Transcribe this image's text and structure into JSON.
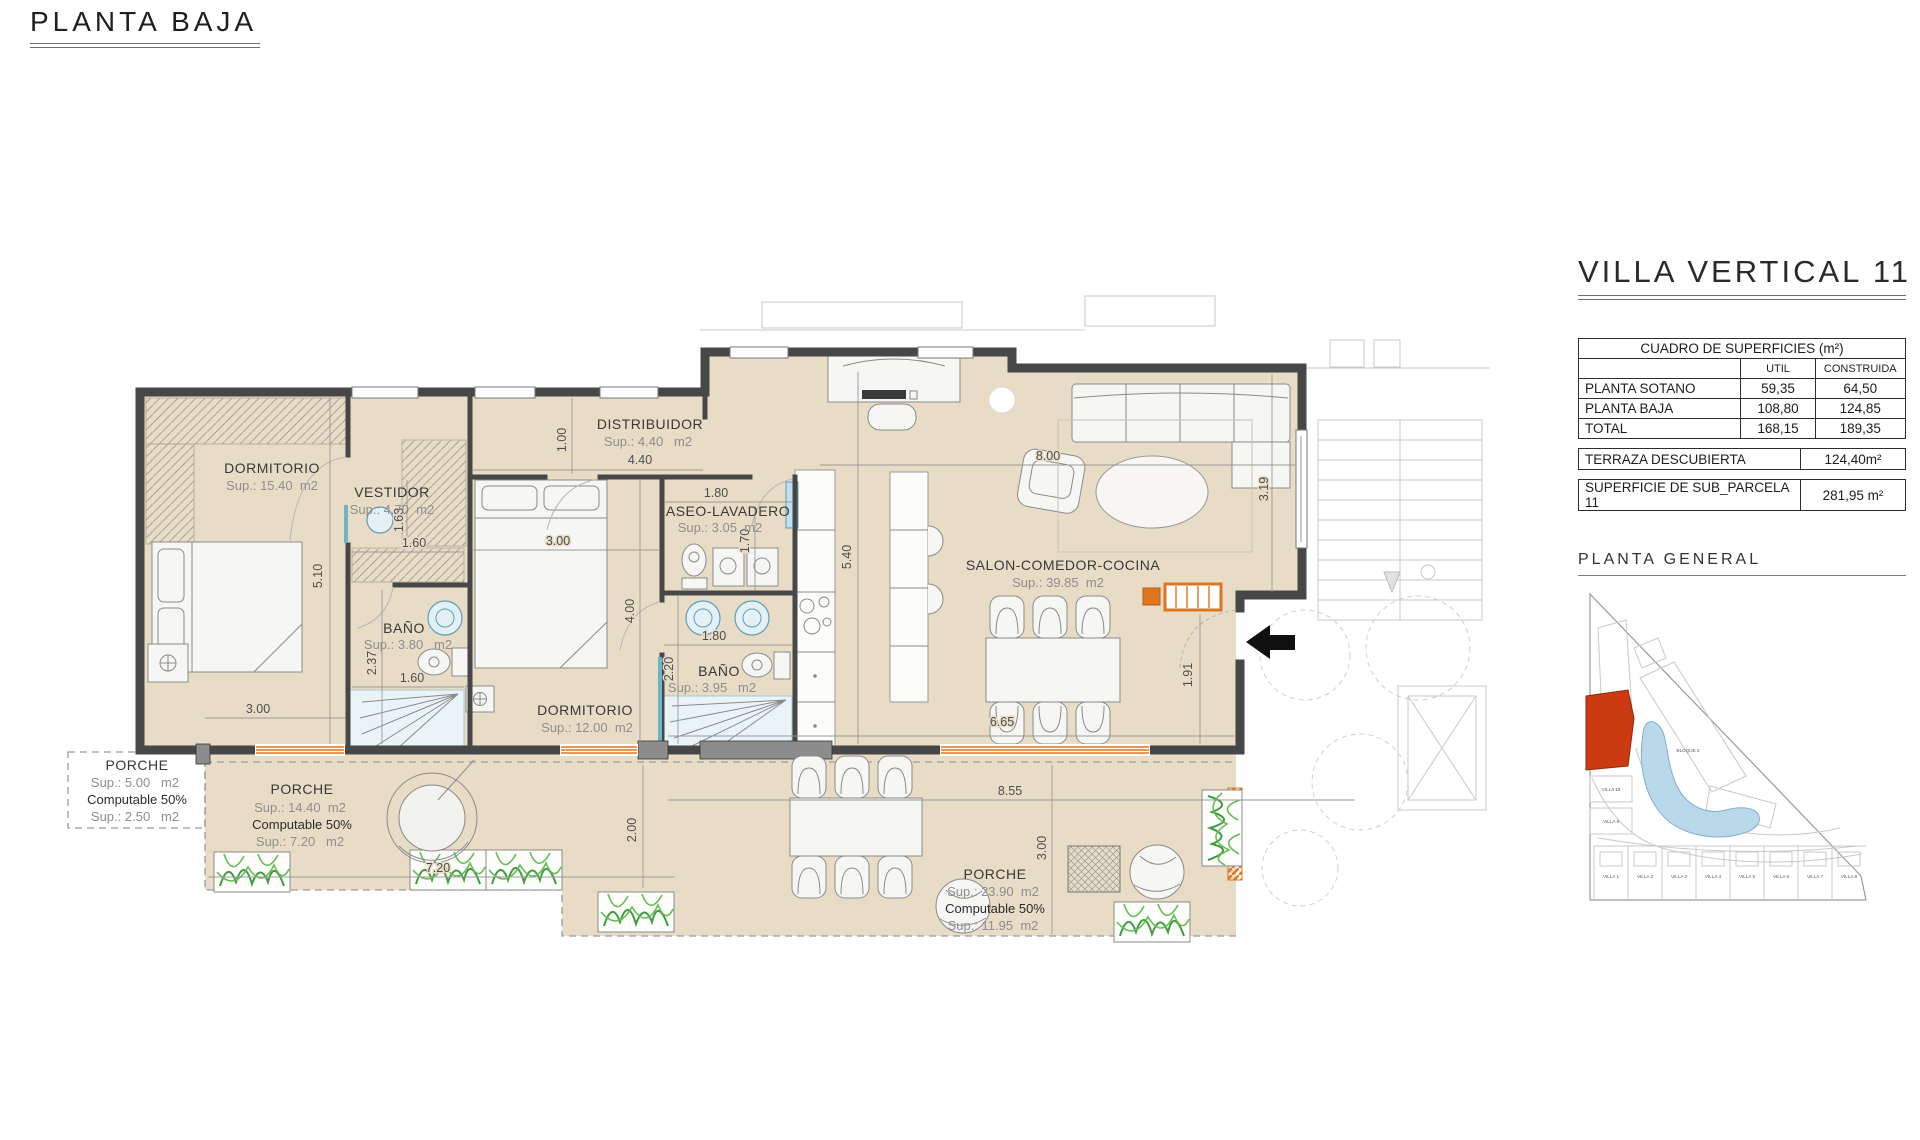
{
  "header": {
    "title": "PLANTA BAJA"
  },
  "right_panel": {
    "title": "VILLA VERTICAL 11",
    "surfaces_table": {
      "title": "CUADRO DE SUPERFICIES (m²)",
      "col_util": "UTIL",
      "col_construida": "CONSTRUIDA",
      "rows": [
        {
          "label": "PLANTA SOTANO",
          "util": "59,35",
          "construida": "64,50"
        },
        {
          "label": "PLANTA BAJA",
          "util": "108,80",
          "construida": "124,85"
        },
        {
          "label": "TOTAL",
          "util": "168,15",
          "construida": "189,35"
        }
      ]
    },
    "terraza": {
      "label": "TERRAZA DESCUBIERTA",
      "value": "124,40m²"
    },
    "parcela": {
      "label": "SUPERFICIE DE SUB_PARCELA  11",
      "value": "281,95 m²"
    },
    "site_plan_title": "PLANTA  GENERAL"
  },
  "site_plan": {
    "bloque2": "BLOQUE 2",
    "villa10": "VILLA 10",
    "villa9": "VILLA 9",
    "villas_row": [
      "VILLA 1",
      "VILLA 2",
      "VILLA 3",
      "VILLA 4",
      "VILLA 5",
      "VILLA 6",
      "VILLA 7",
      "VILLA 8"
    ]
  },
  "floorplan": {
    "rooms": {
      "dormitorio1": {
        "name": "DORMITORIO",
        "sup": "Sup.: 15.40  m2"
      },
      "vestidor": {
        "name": "VESTIDOR",
        "sup": "Sup.: 4.70  m2"
      },
      "distribuidor": {
        "name": "DISTRIBUIDOR",
        "sup": "Sup.: 4.40   m2"
      },
      "aseo": {
        "name": "ASEO-LAVADERO",
        "sup": "Sup.: 3.05  m2"
      },
      "bano1": {
        "name": "BAÑO",
        "sup": "Sup.: 3.80   m2"
      },
      "dormitorio2": {
        "name": "DORMITORIO",
        "sup": "Sup.: 12.00  m2"
      },
      "bano2": {
        "name": "BAÑO",
        "sup": "Sup.: 3.95   m2"
      },
      "salon": {
        "name": "SALON-COMEDOR-COCINA",
        "sup": "Sup.: 39.85  m2"
      },
      "porche1": {
        "name": "PORCHE",
        "sup": "Sup.: 5.00   m2",
        "computable": "Computable 50%",
        "sup2": "Sup.: 2.50   m2"
      },
      "porche2": {
        "name": "PORCHE",
        "sup": "Sup.: 14.40  m2",
        "computable": "Computable 50%",
        "sup2": "Sup.: 7.20   m2"
      },
      "porche3": {
        "name": "PORCHE",
        "sup": "Sup.: 23.90  m2",
        "computable": "Computable 50%",
        "sup2": "Sup.: 11.95  m2"
      }
    },
    "dims": {
      "d100": "1.00",
      "d440": "4.40",
      "d300a": "3.00",
      "d510": "5.10",
      "d237": "2.37",
      "d160a": "1.60",
      "d160b": "1.60",
      "d163": "1.63",
      "d300b": "3.00",
      "d400": "4.00",
      "d180a": "1.80",
      "d170": "1.70",
      "d180b": "1.80",
      "d220": "2.20",
      "d540": "5.40",
      "d800": "8.00",
      "d319": "3.19",
      "d191": "1.91",
      "d665": "6.65",
      "d855": "8.55",
      "d200": "2.00",
      "d300c": "3.00",
      "d720": "7.20"
    }
  },
  "colors": {
    "floor": "#e8dcc6",
    "accent_orange": "#e0751f",
    "highlight_red": "#cc3a12",
    "pool_blue": "#b9d8ea"
  }
}
